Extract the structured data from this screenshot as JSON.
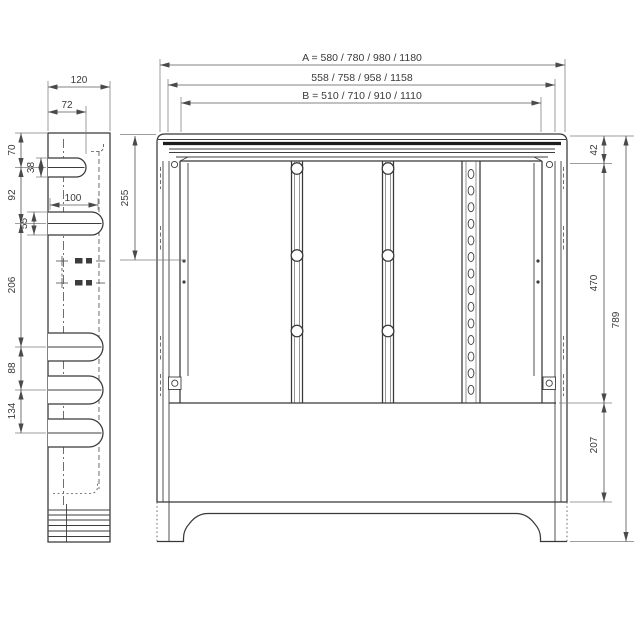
{
  "colors": {
    "background": "#ffffff",
    "outline": "#383838",
    "thick_band": "#1d1d1d",
    "dimension": "#5a5a5a"
  },
  "side_view": {
    "width": "120",
    "upper_slot_offset": "72",
    "top_to_slot1": "70",
    "slot1_width": "38",
    "slot1_to_slot2": "92",
    "slot2_width": "55",
    "slot2_length": "100",
    "slot2_to_slot3": "206",
    "slot3_to_slot4": "88",
    "slot4_to_slot5": "134"
  },
  "front_view": {
    "overall_width_a": "A = 580 / 780 / 980 / 1180",
    "frame_width": "558 / 758 / 958 / 1158",
    "inner_width_b": "B = 510 / 710 / 910 / 1110",
    "bracket_hole_offset": "255",
    "top_band_height": "42",
    "rail_zone_height": "470",
    "base_panel_height": "207",
    "overall_height": "789"
  }
}
